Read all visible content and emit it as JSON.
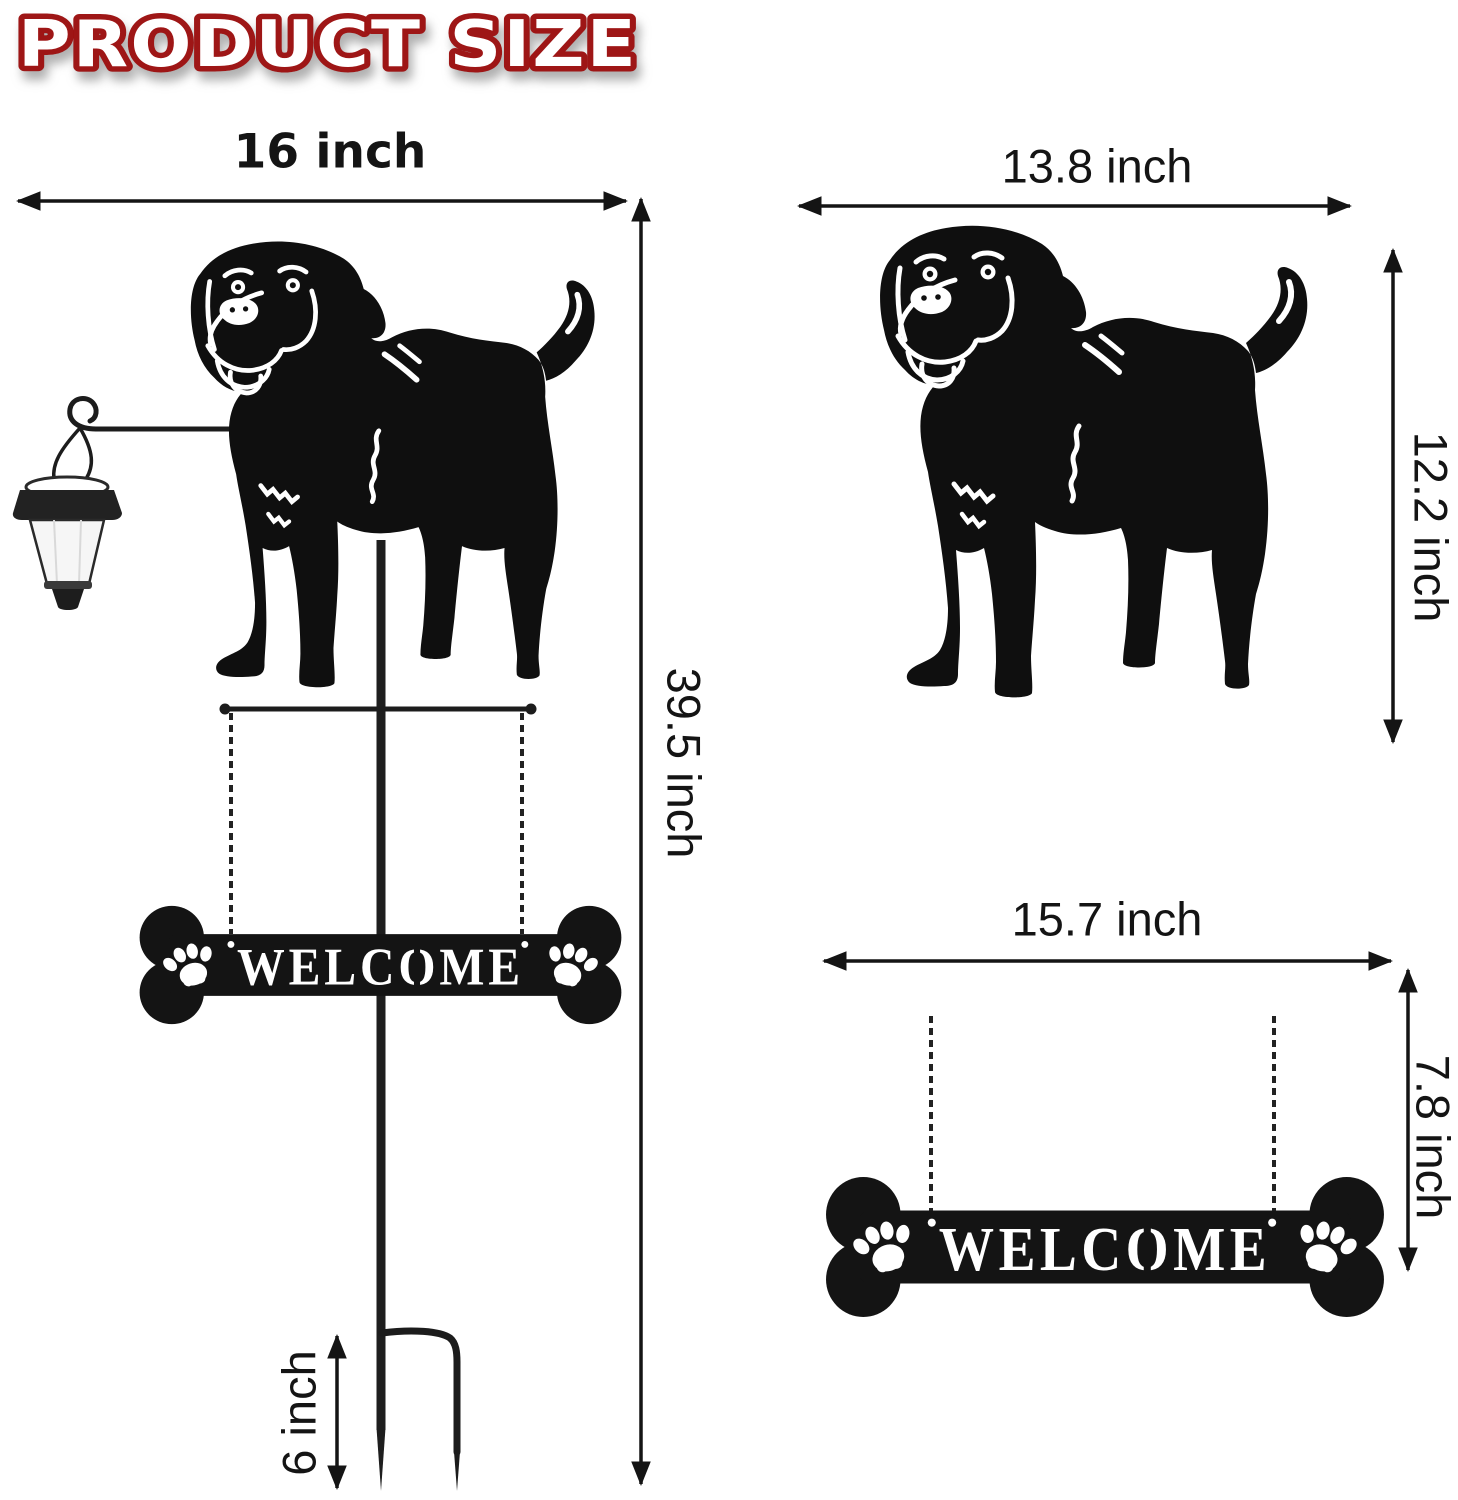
{
  "title": "PRODUCT SIZE",
  "colors": {
    "title_fill": "#ffffff",
    "title_outline": "#9e1212",
    "ink": "#141414",
    "silhouette": "#0f0f0f",
    "lantern_body": "#f6f6f6"
  },
  "full_assembly": {
    "width_label": "16 inch",
    "height_label": "39.5 inch",
    "stake_depth_label": "6 inch"
  },
  "dog_cutout": {
    "width_label": "13.8 inch",
    "height_label": "12.2 inch"
  },
  "welcome_sign": {
    "text": "WELCOME",
    "width_label": "15.7 inch",
    "height_label": "7.8 inch"
  }
}
